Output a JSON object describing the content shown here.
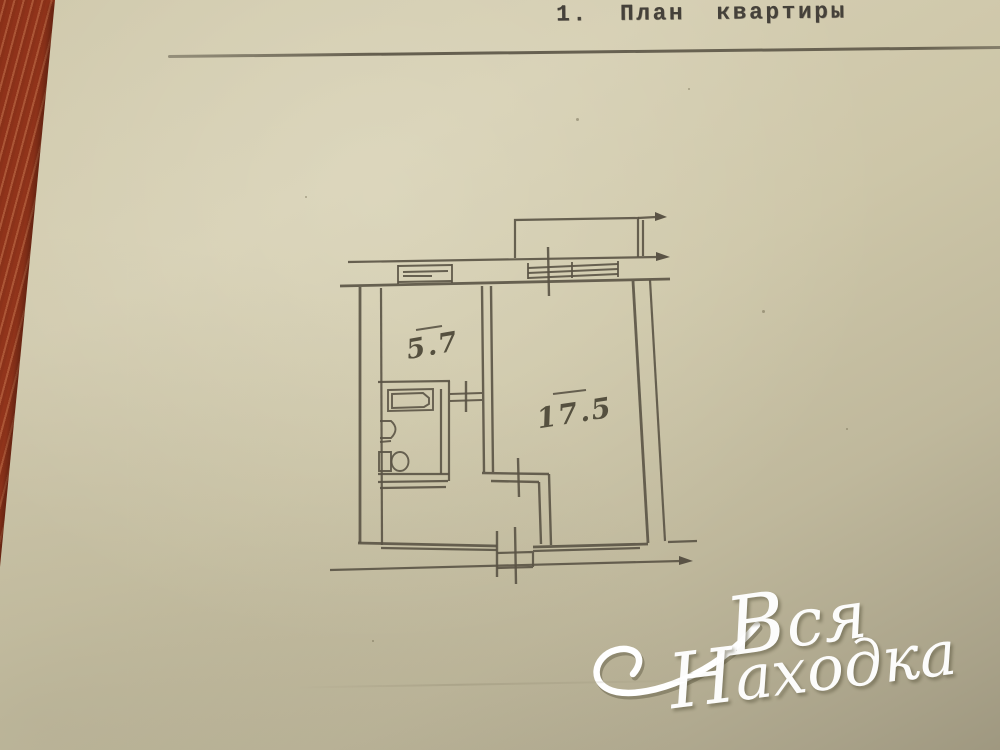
{
  "document": {
    "title": "1. План квартиры",
    "floor_plan": {
      "kitchen_area": "5.7",
      "room_area": "17.5"
    },
    "watermark": {
      "line1": "Вся",
      "line2": "Находка"
    },
    "colors": {
      "paper": "#cdc6a9",
      "ink": "#5a5345",
      "title_ink": "#45413a",
      "wood": "#9c3b22",
      "watermark": "#ffffff"
    }
  }
}
